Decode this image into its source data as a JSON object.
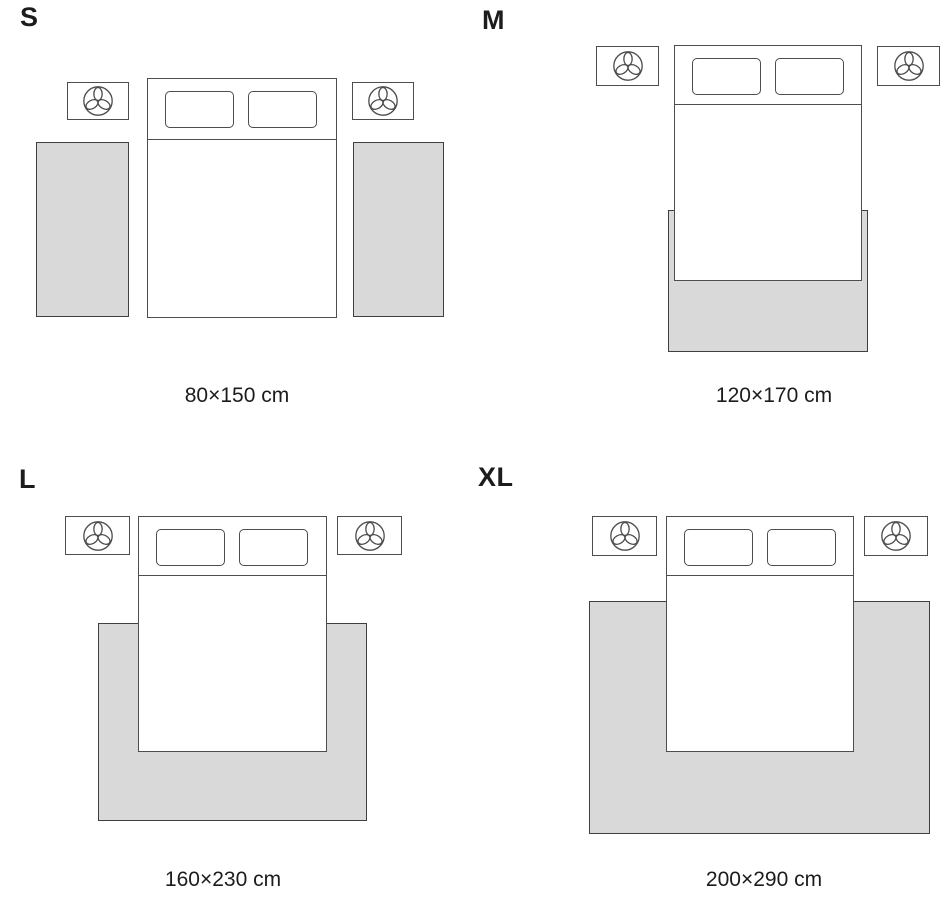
{
  "title": "Rug size guide bedroom layouts",
  "colors": {
    "background": "#ffffff",
    "rug_fill": "#d9d9d9",
    "rug_border": "#3f3f3f",
    "furniture_line": "#4d4d4d",
    "text": "#1c1c1c"
  },
  "icons": {
    "nightstand": "plant-icon"
  },
  "panels": [
    {
      "id": "s",
      "letter": "S",
      "size_label": "80×150 cm",
      "rug_placement": "two runner rugs, one on each side of the bed"
    },
    {
      "id": "m",
      "letter": "M",
      "size_label": "120×170 cm",
      "rug_placement": "one rug under the foot of the bed, slightly wider than the bed"
    },
    {
      "id": "l",
      "letter": "L",
      "size_label": "160×230 cm",
      "rug_placement": "one rug under the lower part of the bed, extending past both sides"
    },
    {
      "id": "xl",
      "letter": "XL",
      "size_label": "200×290 cm",
      "rug_placement": "one large rug under the bed, extending far beyond both sides and the foot"
    }
  ]
}
